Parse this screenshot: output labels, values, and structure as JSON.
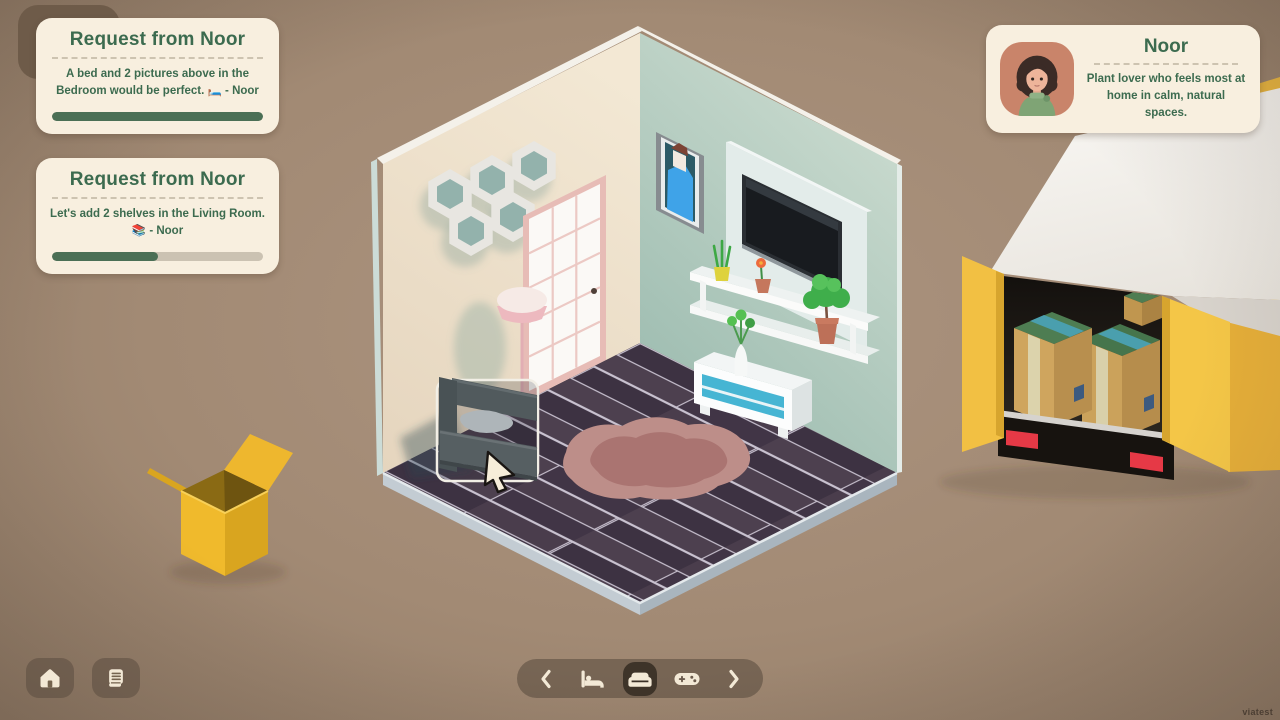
{
  "ui": {
    "requests": [
      {
        "title": "Request from Noor",
        "body": "A bed and 2 pictures above in the Bedroom would be perfect. 🛏️ - Noor",
        "progress": 100
      },
      {
        "title": "Request from Noor",
        "body": "Let's add 2 shelves in the Living Room. 📚 - Noor",
        "progress": 50
      }
    ],
    "character": {
      "name": "Noor",
      "description": "Plant lover who feels most at home in calm, natural spaces.",
      "avatar_icon": "woman-curly-hair-green-sweater"
    },
    "nav": {
      "prev_icon": "chevron-left-icon",
      "next_icon": "chevron-right-icon",
      "rooms": [
        {
          "label": "bedroom",
          "icon": "bed-icon",
          "selected": false
        },
        {
          "label": "living-room",
          "icon": "couch-icon",
          "selected": true
        },
        {
          "label": "playroom",
          "icon": "controller-icon",
          "selected": false
        }
      ]
    },
    "corner_buttons": [
      {
        "icon": "home-icon"
      },
      {
        "icon": "journal-icon"
      }
    ],
    "watermark": "viatest"
  },
  "palette": {
    "card_bg": "#f8efdf",
    "heading_green": "#3c6b4f",
    "progress_fill": "#4b6f55",
    "progress_track": "#cbc2b2",
    "background_brown": "#a58d77",
    "truck_yellow": "#f2c043",
    "accent_teal": "#46b5d3",
    "floor_plum": "#46394a",
    "wall_cream": "#efe3cf",
    "wall_sage": "#b7cfc3"
  },
  "scene": {
    "objects": [
      "hexagon-wall-shelves",
      "french-door",
      "floor-lamp",
      "portrait-picture",
      "tv-panel",
      "tv",
      "wall-shelves",
      "snake-plant",
      "flower-pot",
      "small-tree",
      "tv-stand",
      "vase-of-flowers",
      "area-rug",
      "couch-drag-preview",
      "pointer-cursor",
      "moving-truck",
      "cargo-boxes",
      "open-cardboard-box"
    ]
  }
}
